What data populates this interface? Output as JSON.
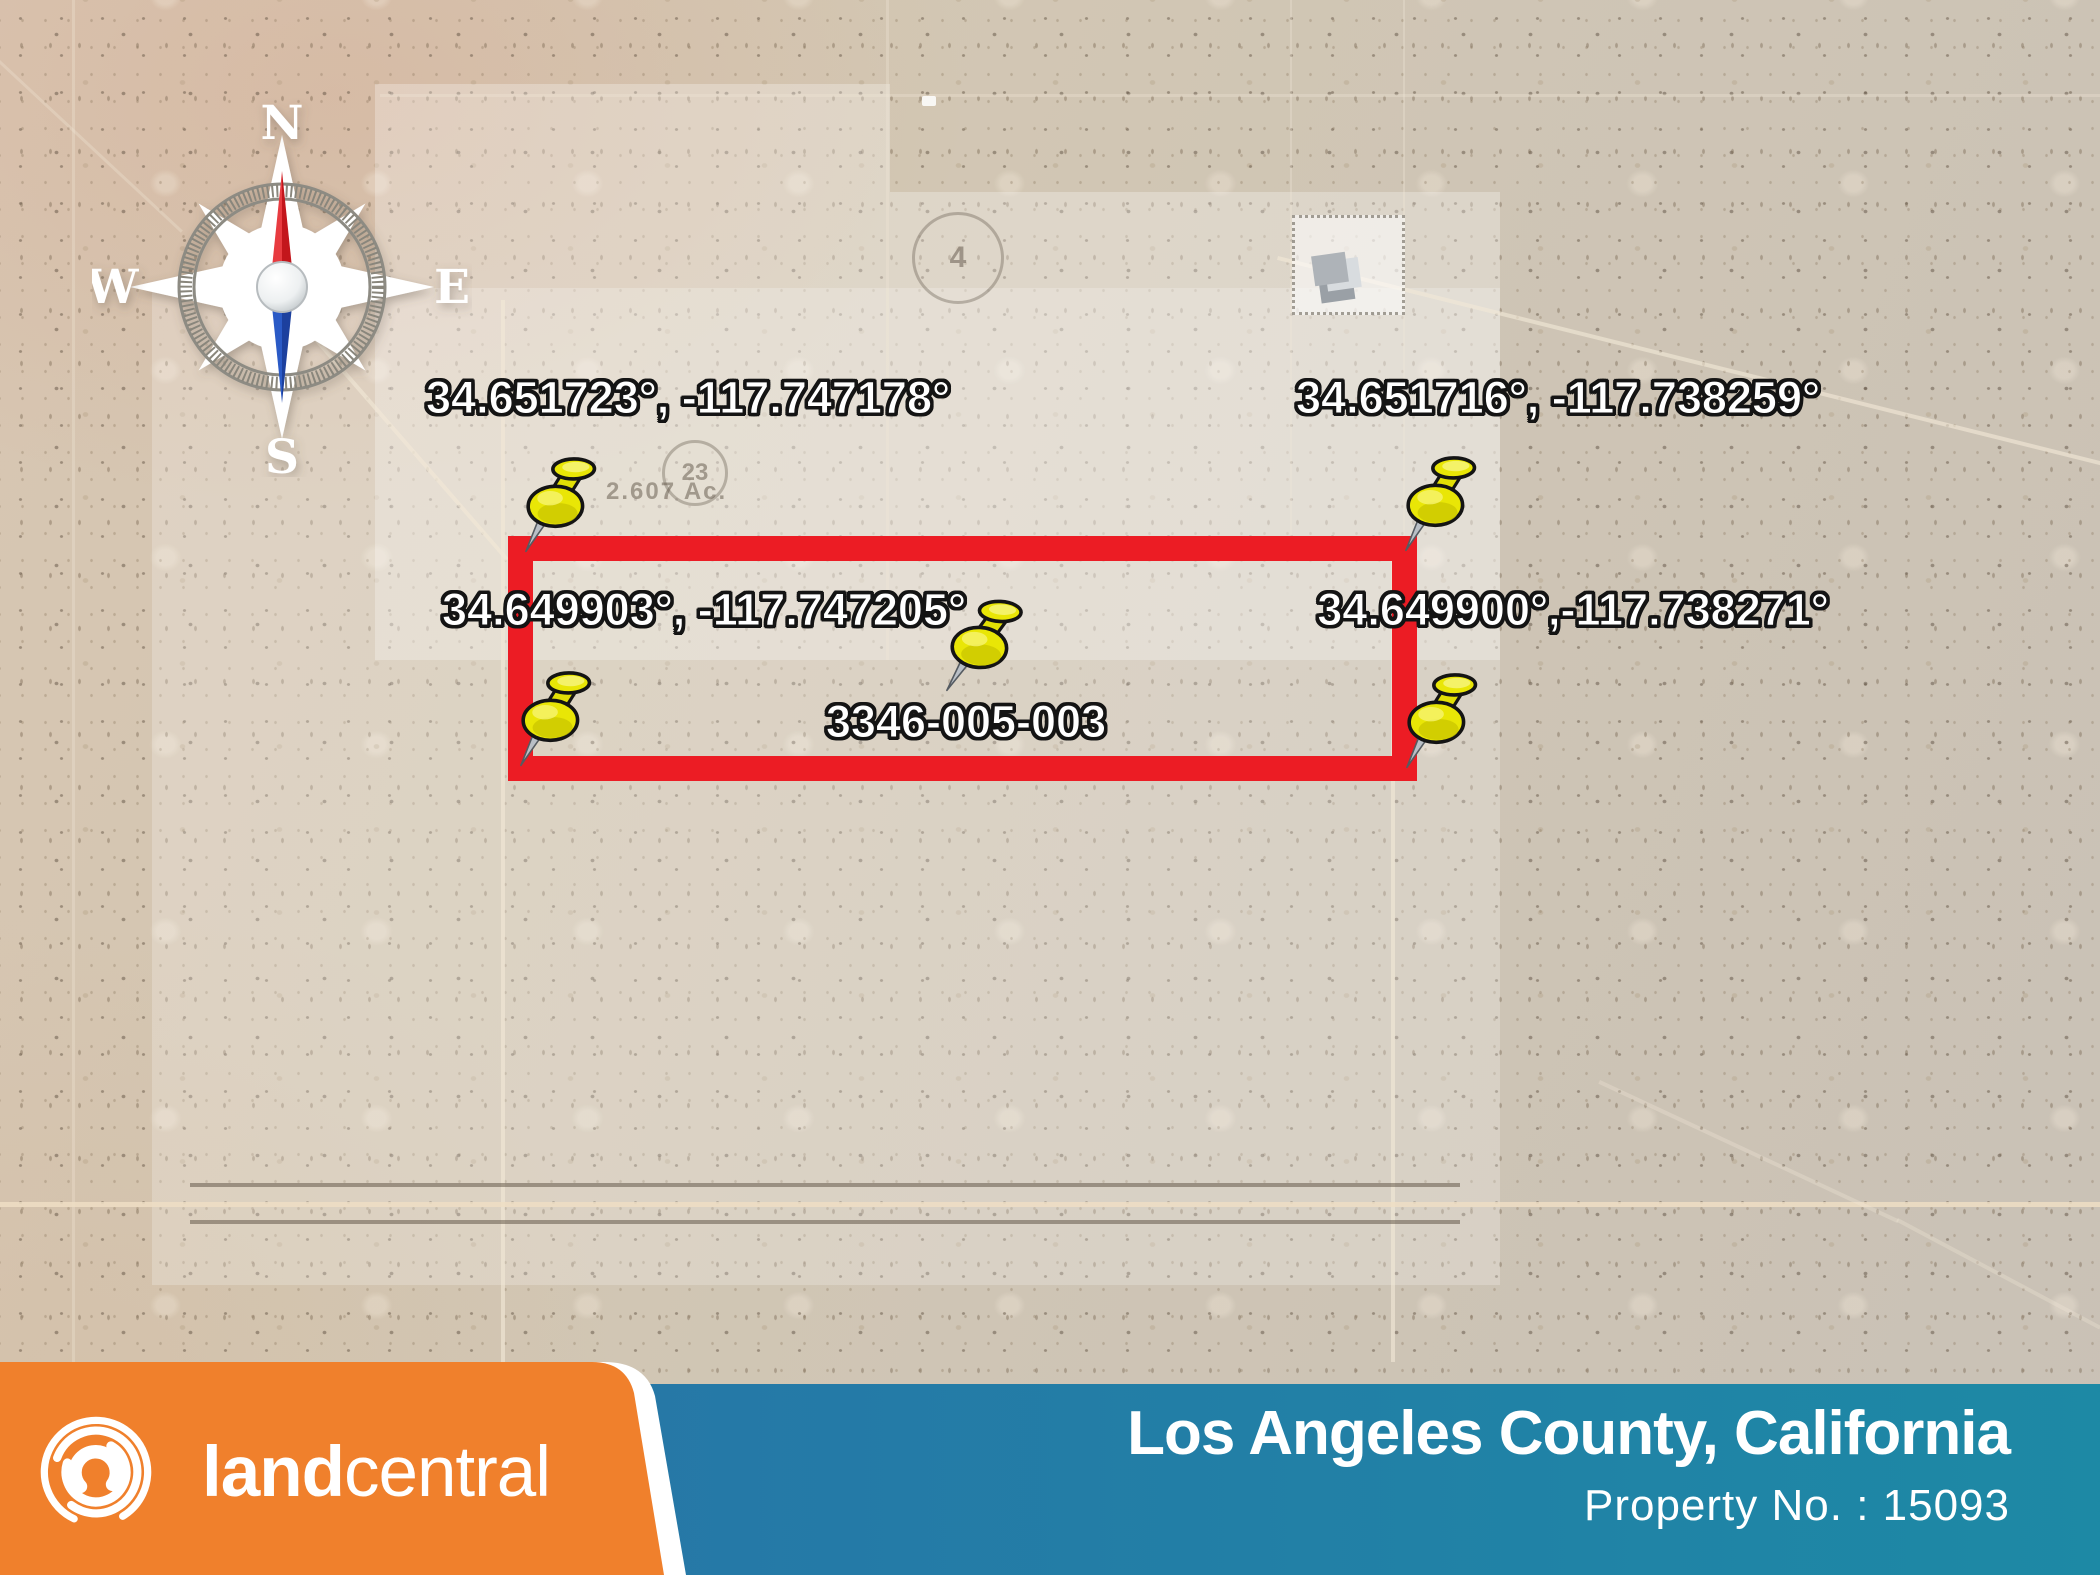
{
  "map": {
    "compass": {
      "n": "N",
      "e": "E",
      "s": "S",
      "w": "W"
    },
    "labels": {
      "corner_top_left": "34.651723°, -117.747178°",
      "corner_top_right": "34.651716°, -117.738259°",
      "corner_bottom_left": "34.649903°, -117.747205°",
      "corner_bottom_right": "34.649900°,-117.738271°",
      "apn": "3346-005-003"
    },
    "faint": {
      "lot23": "23",
      "lot4": "4",
      "acreage": "2.607 Ac."
    }
  },
  "footer": {
    "logo_bold": "land",
    "logo_light": "central",
    "county": "Los Angeles County, California",
    "property_no": "Property No. : 15093"
  },
  "colors": {
    "parcel_outline": "#ec1c24",
    "pin_yellow": "#e9e606",
    "brand_orange": "#f0802c",
    "banner_blue_left": "#2e73a2",
    "banner_blue_right": "#1d89a5",
    "terrain_base": "#d3c7b5"
  }
}
